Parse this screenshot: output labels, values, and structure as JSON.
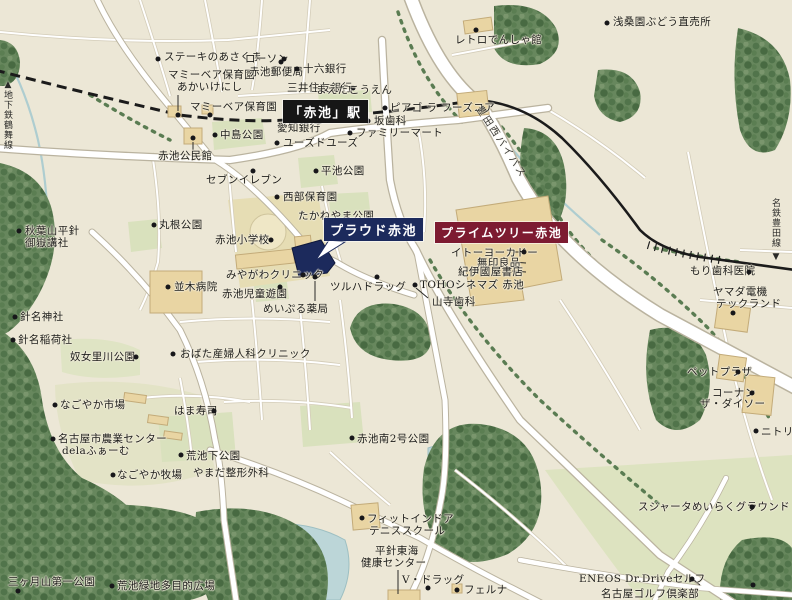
{
  "map": {
    "area_title": "赤池駅周辺 案内図",
    "colors": {
      "background": "#ece7d6",
      "proud_navy": "#1c2a5c",
      "primetree_maroon": "#7d1b31",
      "station_black": "#161616",
      "road_white": "#ffffff",
      "forest_green": "#5e8055",
      "park_green": "#d9e1bd",
      "building_tan": "#e9d5a3",
      "water_blue": "#bcd6d8"
    },
    "landmarks": [
      {
        "name": "proud-akaike-flag",
        "text": "プラウド赤池",
        "x": 324,
        "y": 218,
        "bg": "#1c2a5c",
        "fg": "#ffffff",
        "fs": 13
      },
      {
        "name": "primetree-akaike-flag",
        "text": "プライムツリー赤池",
        "x": 435,
        "y": 222,
        "bg": "#7d1b31",
        "fg": "#ffffff",
        "fs": 12
      },
      {
        "name": "akaike-station-flag",
        "text": "「赤池」駅",
        "x": 283,
        "y": 100,
        "bg": "#161616",
        "fg": "#ffffff",
        "fs": 13
      }
    ],
    "labels": [
      {
        "name": "label-steak-asakuma",
        "text": "ステーキのあさくま",
        "x": 164,
        "y": 52,
        "dot": [
          158,
          59
        ]
      },
      {
        "name": "label-lawson",
        "text": "ローソン",
        "x": 245,
        "y": 54,
        "dot": [
          284,
          59
        ]
      },
      {
        "name": "label-mammy-bear-akaikenishi-1",
        "text": "マミーベア保育園",
        "x": 168,
        "y": 70
      },
      {
        "name": "label-mammy-bear-akaikenishi-2",
        "text": "あかいけにし",
        "x": 177,
        "y": 82,
        "dot": [
          178,
          115
        ]
      },
      {
        "name": "label-mammy-bear",
        "text": "マミーベア保育園",
        "x": 190,
        "y": 102,
        "dot": [
          210,
          115
        ]
      },
      {
        "name": "label-akaike-post-office",
        "text": "赤池郵便局",
        "x": 249,
        "y": 67,
        "dot": [
          281,
          62
        ]
      },
      {
        "name": "label-juroku-bank",
        "text": "十六銀行",
        "x": 303,
        "y": 64,
        "dot": [
          297,
          69
        ]
      },
      {
        "name": "label-smbc-bank",
        "text": "三井住友銀行",
        "x": 287,
        "y": 83,
        "dot": [
          353,
          88
        ]
      },
      {
        "name": "label-maeda-kouen",
        "text": "まえだこうえん",
        "x": 316,
        "y": 85
      },
      {
        "name": "label-aichi-bank",
        "text": "愛知銀行",
        "x": 277,
        "y": 123
      },
      {
        "name": "label-retro-densha-kan",
        "text": "レトロでんしゃ館",
        "x": 455,
        "y": 35,
        "dot": [
          476,
          30
        ]
      },
      {
        "name": "label-asakuwaen-grape",
        "text": "浅桑園ぶどう直売所",
        "x": 613,
        "y": 17,
        "dot": [
          607,
          23
        ]
      },
      {
        "name": "label-piago-la-foods-core",
        "text": "ピアゴ ラ フーズコア",
        "x": 390,
        "y": 103,
        "dot": [
          385,
          108
        ]
      },
      {
        "name": "label-saka-dental",
        "text": "坂歯科",
        "x": 374,
        "y": 116,
        "dot": [
          368,
          121
        ]
      },
      {
        "name": "label-family-mart",
        "text": "ファミリーマート",
        "x": 356,
        "y": 128,
        "dot": [
          350,
          133
        ]
      },
      {
        "name": "label-used-use",
        "text": "ユーズドユーズ",
        "x": 283,
        "y": 138,
        "dot": [
          277,
          143
        ]
      },
      {
        "name": "label-nakashima-park",
        "text": "中島公園",
        "x": 220,
        "y": 130,
        "dot": [
          215,
          135
        ]
      },
      {
        "name": "label-akaike-kominkan",
        "text": "赤池公民館",
        "x": 158,
        "y": 151,
        "dot": [
          193,
          138
        ]
      },
      {
        "name": "label-seven-eleven",
        "text": "セブンイレブン",
        "x": 206,
        "y": 175,
        "dot": [
          253,
          171
        ]
      },
      {
        "name": "label-hiraike-park",
        "text": "平池公園",
        "x": 321,
        "y": 166,
        "dot": [
          316,
          171
        ]
      },
      {
        "name": "label-seibu-hoikuen",
        "text": "西部保育園",
        "x": 283,
        "y": 192,
        "dot": [
          277,
          197
        ]
      },
      {
        "name": "label-takaneyama-park",
        "text": "たかねやま公園",
        "x": 298,
        "y": 211
      },
      {
        "name": "label-marune-park",
        "text": "丸根公園",
        "x": 159,
        "y": 220,
        "dot": [
          154,
          225
        ]
      },
      {
        "name": "label-akaike-elementary",
        "text": "赤池小学校",
        "x": 215,
        "y": 235,
        "dot": [
          271,
          240
        ]
      },
      {
        "name": "label-miyagawa-clinic",
        "text": "みやがわクリニック",
        "x": 226,
        "y": 270,
        "dot": [
          303,
          275
        ]
      },
      {
        "name": "label-namiki-hospital",
        "text": "並木病院",
        "x": 174,
        "y": 282,
        "dot": [
          168,
          287
        ]
      },
      {
        "name": "label-akaike-jido-yuen",
        "text": "赤池児童遊園",
        "x": 222,
        "y": 289,
        "dot": [
          280,
          287
        ]
      },
      {
        "name": "label-meipuru-pharmacy",
        "text": "めいぷる薬局",
        "x": 263,
        "y": 304,
        "dot": [
          315,
          277
        ]
      },
      {
        "name": "label-tsuruha-drug",
        "text": "ツルハドラッグ",
        "x": 330,
        "y": 282,
        "dot": [
          377,
          277
        ]
      },
      {
        "name": "label-ito-yokado",
        "text": "イトーヨーカドー",
        "x": 451,
        "y": 248,
        "dot": [
          524,
          252
        ]
      },
      {
        "name": "label-muji",
        "text": "無印良品",
        "x": 477,
        "y": 258
      },
      {
        "name": "label-kinokuniya",
        "text": "紀伊國屋書店",
        "x": 458,
        "y": 267
      },
      {
        "name": "label-toho-cinemas",
        "text": "TOHOシネマズ 赤池",
        "x": 420,
        "y": 280
      },
      {
        "name": "label-yamadera-dental",
        "text": "山寺歯科",
        "x": 432,
        "y": 297,
        "dot": [
          415,
          285
        ]
      },
      {
        "name": "label-obata-clinic",
        "text": "おばた産婦人科クリニック",
        "x": 180,
        "y": 349,
        "dot": [
          173,
          354
        ]
      },
      {
        "name": "label-akiba-kosha-1",
        "text": "秋葉山平針",
        "x": 25,
        "y": 226,
        "dot": [
          19,
          231
        ]
      },
      {
        "name": "label-akiba-kosha-2",
        "text": "御嶽講社",
        "x": 25,
        "y": 238
      },
      {
        "name": "label-haimyo-shrine",
        "text": "針名神社",
        "x": 20,
        "y": 312,
        "dot": [
          15,
          317
        ]
      },
      {
        "name": "label-haimyo-inari",
        "text": "針名稲荷社",
        "x": 18,
        "y": 335,
        "dot": [
          13,
          340
        ]
      },
      {
        "name": "label-numeri-river-park",
        "text": "奴女里川公園",
        "x": 70,
        "y": 352,
        "dot": [
          136,
          357
        ]
      },
      {
        "name": "label-nagoyaka-market",
        "text": "なごやか市場",
        "x": 60,
        "y": 400,
        "dot": [
          55,
          405
        ]
      },
      {
        "name": "label-hama-sushi",
        "text": "はま寿司",
        "x": 174,
        "y": 406,
        "dot": [
          214,
          411
        ]
      },
      {
        "name": "label-agri-center-1",
        "text": "名古屋市農業センター",
        "x": 58,
        "y": 434,
        "dot": [
          53,
          439
        ]
      },
      {
        "name": "label-agri-center-2",
        "text": "delaふぁーむ",
        "x": 62,
        "y": 446
      },
      {
        "name": "label-nagoyaka-bokujo",
        "text": "なごやか牧場",
        "x": 117,
        "y": 470,
        "dot": [
          113,
          475
        ]
      },
      {
        "name": "label-araikeshita-park",
        "text": "荒池下公園",
        "x": 186,
        "y": 451,
        "dot": [
          181,
          455
        ]
      },
      {
        "name": "label-yamada-seikei",
        "text": "やまだ整形外科",
        "x": 193,
        "y": 468
      },
      {
        "name": "label-akaike-minami2-park",
        "text": "赤池南2号公園",
        "x": 357,
        "y": 434,
        "dot": [
          352,
          438
        ]
      },
      {
        "name": "label-fit-indoor-1",
        "text": "フィットインドア",
        "x": 367,
        "y": 514,
        "dot": [
          362,
          518
        ]
      },
      {
        "name": "label-fit-indoor-2",
        "text": "テニススクール",
        "x": 369,
        "y": 526
      },
      {
        "name": "label-hirabari-tokai-1",
        "text": "平針東海",
        "x": 375,
        "y": 546
      },
      {
        "name": "label-hirabari-tokai-2",
        "text": "健康センター",
        "x": 361,
        "y": 558
      },
      {
        "name": "label-v-drug",
        "text": "V・ドラッグ",
        "x": 402,
        "y": 575,
        "dot": [
          428,
          588
        ]
      },
      {
        "name": "label-felna",
        "text": "フェルナ",
        "x": 464,
        "y": 585,
        "dot": [
          457,
          590
        ]
      },
      {
        "name": "label-sujahta-ground",
        "text": "スジャータめいらくグラウンド",
        "x": 638,
        "y": 502,
        "dot": [
          752,
          507
        ]
      },
      {
        "name": "label-eneos-drdrive",
        "text": "ENEOS Dr.Driveセルフ",
        "x": 579,
        "y": 574,
        "dot": [
          692,
          579
        ]
      },
      {
        "name": "label-nagoya-golf-club",
        "text": "名古屋ゴルフ倶楽部",
        "x": 601,
        "y": 589,
        "dot": [
          753,
          585
        ]
      },
      {
        "name": "label-mori-dental",
        "text": "もり歯科医院",
        "x": 690,
        "y": 266,
        "dot": [
          749,
          272
        ]
      },
      {
        "name": "label-yamada-denki-1",
        "text": "ヤマダ電機",
        "x": 713,
        "y": 287
      },
      {
        "name": "label-yamada-denki-2",
        "text": "テックランド",
        "x": 716,
        "y": 299,
        "dot": [
          733,
          313
        ]
      },
      {
        "name": "label-pet-plaza",
        "text": "ペットプラザ",
        "x": 687,
        "y": 367,
        "dot": [
          738,
          372
        ]
      },
      {
        "name": "label-kohnan",
        "text": "コーナン",
        "x": 712,
        "y": 388,
        "dot": [
          752,
          393
        ]
      },
      {
        "name": "label-daiso",
        "text": "ザ・ダイソー",
        "x": 700,
        "y": 399
      },
      {
        "name": "label-nitori",
        "text": "ニトリ",
        "x": 761,
        "y": 427,
        "dot": [
          756,
          431
        ]
      },
      {
        "name": "label-mikazuki-park",
        "text": "三ヶ月山第一公園",
        "x": 8,
        "y": 577,
        "dot": [
          18,
          591
        ]
      },
      {
        "name": "label-araike-ryokuchi",
        "text": "荒池緑地多目的広場",
        "x": 117,
        "y": 581,
        "dot": [
          112,
          586
        ]
      }
    ],
    "vertical_labels": [
      {
        "name": "subway-tsurumai-line-label",
        "text": "地下鉄鶴舞線",
        "x": 2,
        "y": 90,
        "arrow": "▲",
        "arrow_x": 3,
        "arrow_y": 80
      },
      {
        "name": "meitetsu-toyota-line-label",
        "text": "名鉄豊田線",
        "x": 770,
        "y": 198,
        "arrow": "▼",
        "arrow_x": 771,
        "arrow_y": 252
      }
    ],
    "rotated_labels": [
      {
        "name": "toyota-west-bypass-label",
        "text": "豊田西バイパス",
        "x": 486,
        "y": 102,
        "angle": 57
      }
    ]
  }
}
